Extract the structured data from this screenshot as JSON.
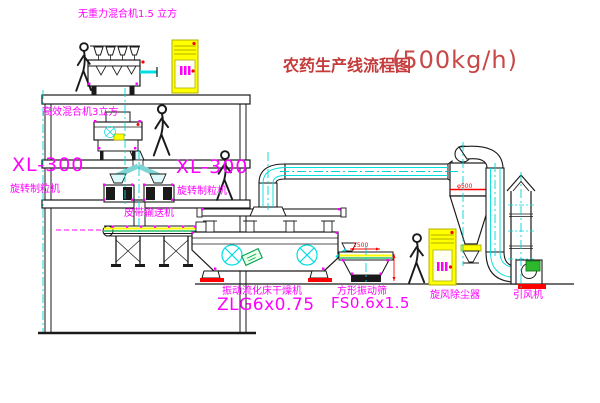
{
  "title": {
    "text": "农药生产线流程图",
    "capacity": "(500kg/h)"
  },
  "labels": {
    "gravity_mixer": "无重力混合机1.5 立方",
    "high_efficiency_mixer": "高效混合机3立方",
    "granulator_left_model": "XL-300",
    "granulator_left_name": "旋转制粒机",
    "granulator_right_model": "XL-300",
    "granulator_right_name": "旋转制粒机",
    "belt_conveyor": "皮带输送机",
    "fluid_bed_dryer_name": "振动流化床干燥机",
    "fluid_bed_dryer_model": "ZLG6x0.75",
    "square_sieve_name": "方形振动筛",
    "square_sieve_model": "FS0.6x1.5",
    "cyclone_dust_collector": "旋风除尘器",
    "induced_draft_fan": "引风机"
  },
  "annotations": {
    "cyclone_diameter": "φ500",
    "sieve_width": "1500"
  },
  "colors": {
    "line": "#1a1a1a",
    "centerline": "#00d5d5",
    "label_magenta": "#ff00ff",
    "title_red": "#c43b3b",
    "cabinet_yellow": "#ffff00",
    "alert_red": "#ff0000",
    "machine_green": "#2eb82e"
  }
}
